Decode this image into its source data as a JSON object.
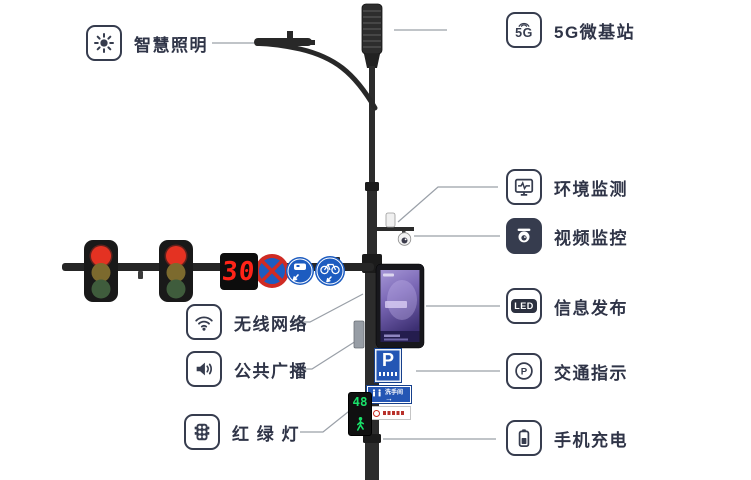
{
  "labels": {
    "left": [
      {
        "id": "smart-lighting",
        "label": "智慧照明"
      },
      {
        "id": "wireless-network",
        "label": "无线网络"
      },
      {
        "id": "public-broadcast",
        "label": "公共广播"
      },
      {
        "id": "traffic-light",
        "label": "红 绿 灯"
      }
    ],
    "right": [
      {
        "id": "5g-base-station",
        "label": "5G微基站",
        "icon_text": "5G"
      },
      {
        "id": "environment-monitoring",
        "label": "环境监测"
      },
      {
        "id": "video-surveillance",
        "label": "视频监控"
      },
      {
        "id": "information-release",
        "label": "信息发布",
        "icon_text": "LED"
      },
      {
        "id": "traffic-indication",
        "label": "交通指示",
        "icon_text": "P"
      },
      {
        "id": "phone-charging",
        "label": "手机充电"
      }
    ]
  },
  "pole": {
    "arm_countdown": "30",
    "pedestrian_countdown": "48",
    "parking_sign_letter": "P",
    "restroom_sign_text": "洗手间",
    "sign_icons": [
      "no-stopping-sign",
      "motor-vehicle-lane-sign",
      "bicycle-lane-sign"
    ]
  },
  "colors": {
    "text": "#2f3447",
    "icon_stroke": "#363c4e",
    "connector_line": "#9aa0a8",
    "pole": "#2c2c2c",
    "signal_red": "#e43222",
    "countdown_red": "#ff2418",
    "pedestrian_green": "#19e26a",
    "sign_blue": "#2456b4",
    "screen_purple": "#7a67b5"
  }
}
